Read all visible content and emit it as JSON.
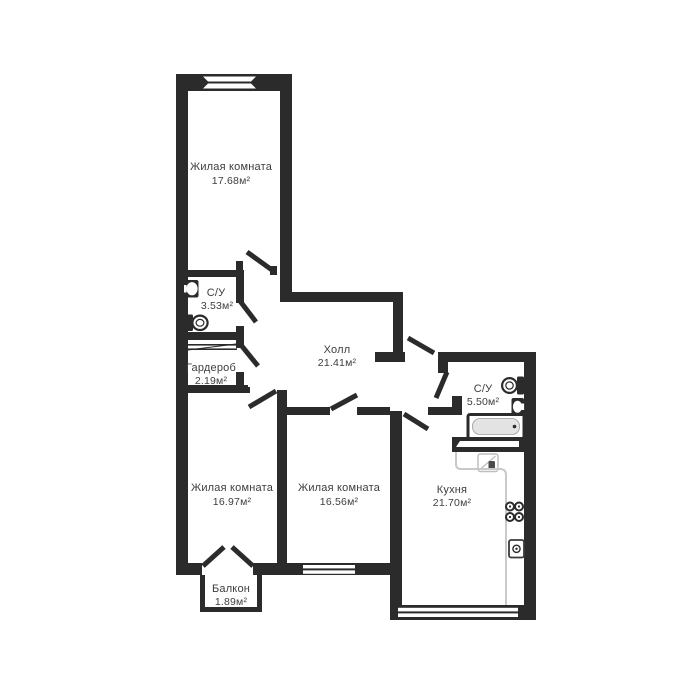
{
  "plan": {
    "type": "apartment-floor-plan",
    "units": "м²"
  },
  "colors": {
    "wall": "#2b2b2b",
    "text": "#3e3e3e",
    "counter": "#c9c9c9",
    "tub_fill": "#e3e3e3",
    "background": "#ffffff"
  },
  "rooms": [
    {
      "id": "living-top",
      "name": "Жилая комната",
      "area": "17.68м²"
    },
    {
      "id": "bathroom-small",
      "name": "С/У",
      "area": "3.53м²"
    },
    {
      "id": "wardrobe",
      "name": "Гардероб",
      "area": "2.19м²"
    },
    {
      "id": "hall",
      "name": "Холл",
      "area": "21.41м²"
    },
    {
      "id": "bathroom-big",
      "name": "С/У",
      "area": "5.50м²"
    },
    {
      "id": "living-left",
      "name": "Жилая комната",
      "area": "16.97м²"
    },
    {
      "id": "living-mid",
      "name": "Жилая комната",
      "area": "16.56м²"
    },
    {
      "id": "kitchen",
      "name": "Кухня",
      "area": "21.70м²"
    },
    {
      "id": "balcony",
      "name": "Балкон",
      "area": "1.89м²"
    }
  ]
}
